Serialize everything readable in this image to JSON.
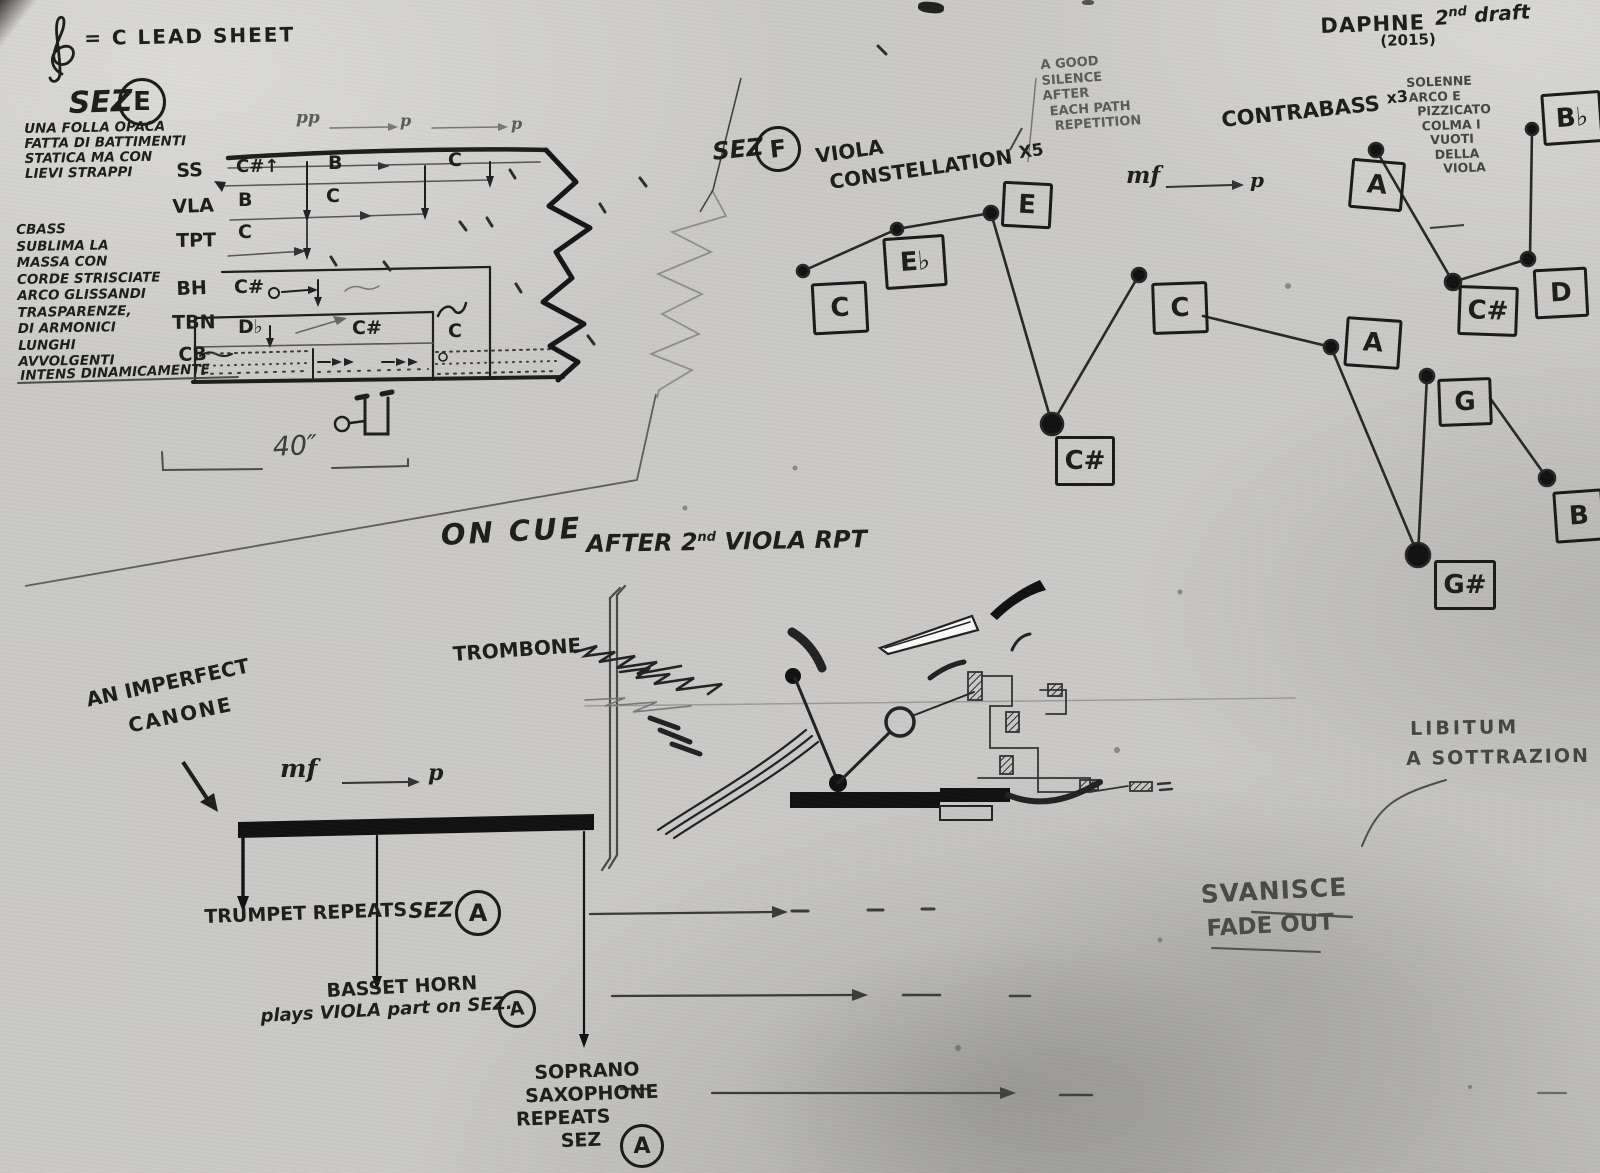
{
  "photo": {
    "paper_color": "#cac9c7",
    "ink_color": "#1d1d1b",
    "pencil_color": "#5b5b59"
  },
  "header": {
    "lead_sheet": "= C LEAD SHEET",
    "title": "DAPHNE",
    "draft_num": "2",
    "draft_sup": "nd",
    "draft_word": "draft",
    "year": "(2015)"
  },
  "sez_e": {
    "label": "SEZ",
    "letter": "E",
    "para1": [
      "UNA FOLLA OPACA",
      "FATTA DI BATTIMENTI",
      "STATICA MA CON",
      "LIEVI STRAPPI"
    ],
    "para2": [
      "CBASS",
      "SUBLIMA LA",
      "MASSA CON",
      "CORDE STRISCIATE",
      "ARCO GLISSANDI",
      "TRASPARENZE,",
      "DI ARMONICI",
      "LUNGHI",
      "AVVOLGENTI"
    ],
    "para2_last": "INTENS DINAMICAMENTE",
    "dyn": [
      "pp",
      "p",
      "p"
    ],
    "rows": [
      {
        "label": "SS",
        "notes": [
          "C#↑",
          "B",
          "C"
        ]
      },
      {
        "label": "VLA",
        "notes": [
          "B",
          "C"
        ]
      },
      {
        "label": "TPT",
        "notes": [
          "C"
        ]
      },
      {
        "label": "BH",
        "notes": [
          "C#"
        ]
      },
      {
        "label": "TBN",
        "notes": [
          "D♭",
          "C#",
          "C"
        ]
      },
      {
        "label": "CB",
        "notes": []
      }
    ],
    "duration": "40″"
  },
  "sez_f": {
    "label": "SEZ",
    "letter": "F",
    "viola": "VIOLA",
    "constellation": "CONSTELLATION",
    "viola_mult": "X5",
    "silence": [
      "A GOOD",
      "SILENCE",
      "AFTER",
      "EACH PATH",
      "REPETITION"
    ],
    "contrabass": "CONTRABASS",
    "contrabass_mult": "x3",
    "dyn_mf": "mf",
    "dyn_p": "p",
    "solenne": [
      "SOLENNE",
      "ARCO E",
      "PIZZICATO",
      "COLMA I",
      "VUOTI",
      "DELLA",
      "VIOLA"
    ],
    "viola_nodes": [
      "C",
      "E♭",
      "E",
      "C#",
      "C",
      "A",
      "G#",
      "G",
      "B"
    ],
    "contrabass_nodes": [
      "A",
      "C#",
      "D",
      "B♭"
    ]
  },
  "cue": {
    "on_cue": "ON CUE",
    "after_1": "AFTER 2",
    "after_sup": "nd",
    "after_2": "VIOLA RPT"
  },
  "canon": {
    "heading1": "AN IMPERFECT",
    "heading2": "CANONE",
    "dyn_mf": "mf",
    "dyn_p": "p",
    "trombone": "TROMBONE",
    "trumpet": "TRUMPET REPEATS",
    "sez": "SEZ",
    "letter": "A",
    "basset1": "BASSET HORN",
    "basset2": "plays VIOLA part on SEZ.",
    "sax": [
      "SOPRANO",
      "SAXOPHONE",
      "REPEATS",
      "SEZ"
    ]
  },
  "outro": {
    "fade1": "SVANISCE",
    "fade2": "FADE OUT",
    "libitum1": "LIBITUM",
    "libitum2": "A SOTTRAZION"
  }
}
